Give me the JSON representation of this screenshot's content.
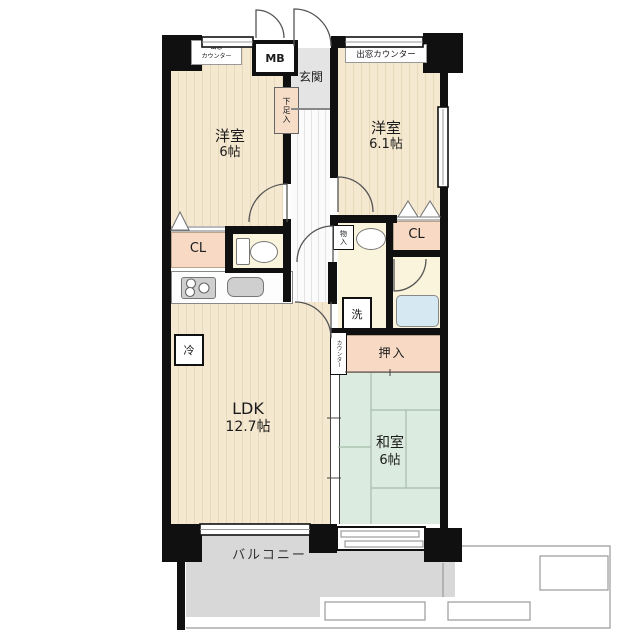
{
  "plan": {
    "rooms": {
      "western1": {
        "name": "洋室",
        "size": "6帖"
      },
      "western2": {
        "name": "洋室",
        "size": "6.1帖"
      },
      "ldk": {
        "name": "LDK",
        "size": "12.7帖"
      },
      "japanese": {
        "name": "和室",
        "size": "6帖"
      },
      "entrance": "玄関",
      "balcony": "バルコニー"
    },
    "labels": {
      "meter_box": "MB",
      "closet_left": "CL",
      "closet_right": "CL",
      "shoe_box": "下足入",
      "storage": "物入",
      "washer": "洗",
      "fridge": "冷",
      "futon_closet": "押入",
      "counter": "カウンター",
      "bay_window_left_l1": "出窓",
      "bay_window_left_l2": "カウンター",
      "bay_window_right": "出窓カウンター"
    },
    "colors": {
      "wall": "#101010",
      "flooring": "#f4e8d0",
      "tatami": "#dcebdf",
      "closet": "#f7d9c4",
      "sanitary": "#faf4dc",
      "bathtub": "#d6e9f2",
      "balcony": "#d8d8d8"
    }
  }
}
